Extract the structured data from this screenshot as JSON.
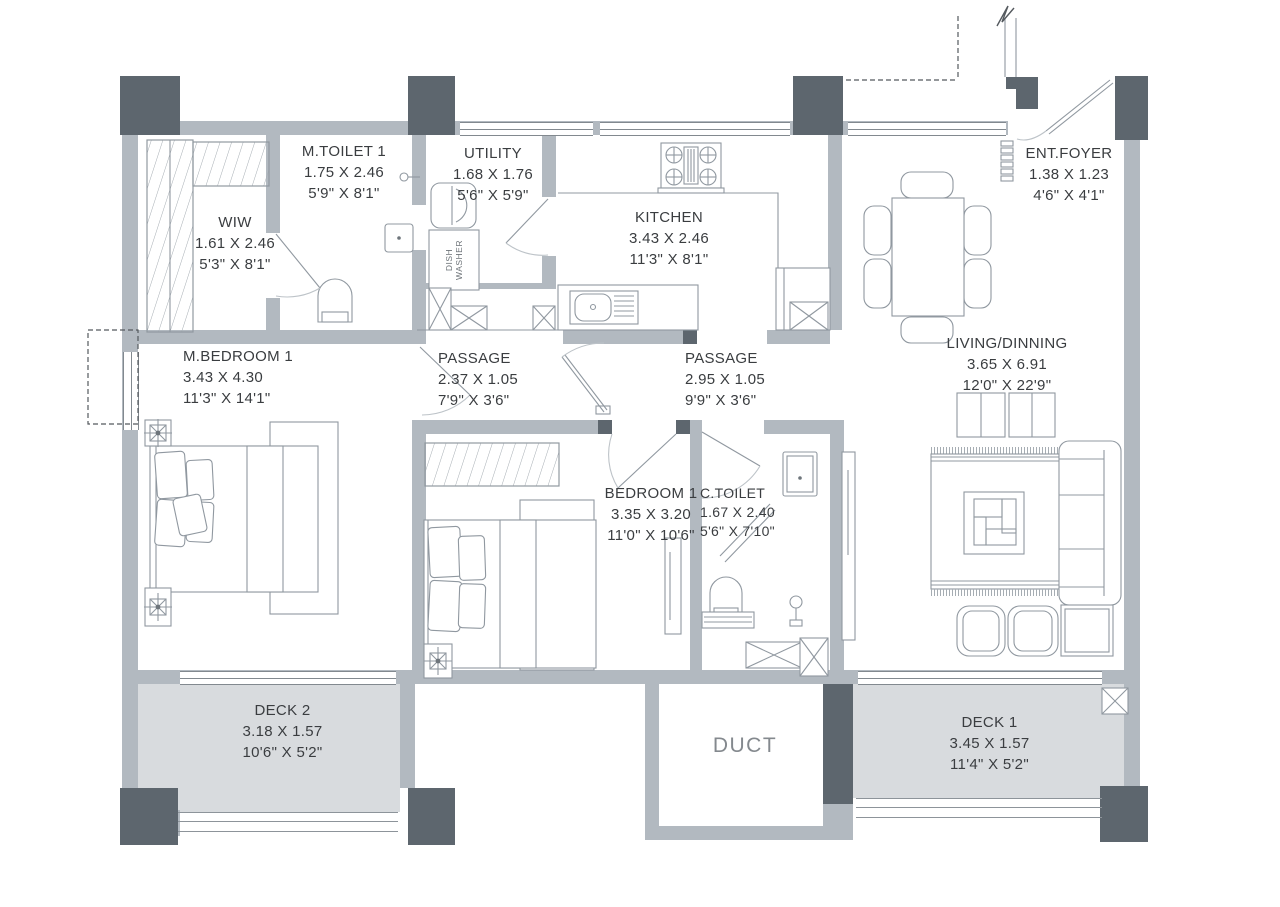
{
  "colors": {
    "wall_light": "#b2b9c0",
    "wall_dark": "#5d666e",
    "deck_fill": "#d8dbde",
    "furniture_line": "#9098a0",
    "text": "#3a3d40",
    "duct_text": "#84898e",
    "background": "#ffffff"
  },
  "rooms": {
    "m_toilet_1": {
      "name": "M.TOILET 1",
      "metric": "1.75 X 2.46",
      "imperial": "5'9\" X 8'1\""
    },
    "utility": {
      "name": "UTILITY",
      "metric": "1.68 X 1.76",
      "imperial": "5'6\" X 5'9\""
    },
    "kitchen": {
      "name": "KITCHEN",
      "metric": "3.43 X 2.46",
      "imperial": "11'3\" X 8'1\""
    },
    "ent_foyer": {
      "name": "ENT.FOYER",
      "metric": "1.38 X 1.23",
      "imperial": "4'6\" X 4'1\""
    },
    "wiw": {
      "name": "WIW",
      "metric": "1.61 X 2.46",
      "imperial": "5'3\" X 8'1\""
    },
    "m_bedroom_1": {
      "name": "M.BEDROOM 1",
      "metric": "3.43 X 4.30",
      "imperial": "11'3\" X 14'1\""
    },
    "passage_1": {
      "name": "PASSAGE",
      "metric": "2.37 X 1.05",
      "imperial": "7'9\" X 3'6\""
    },
    "passage_2": {
      "name": "PASSAGE",
      "metric": "2.95 X 1.05",
      "imperial": "9'9\" X 3'6\""
    },
    "living_dining": {
      "name": "LIVING/DINNING",
      "metric": "3.65 X 6.91",
      "imperial": "12'0\" X 22'9\""
    },
    "bedroom_1": {
      "name": "BEDROOM 1",
      "metric": "3.35 X 3.20",
      "imperial": "11'0\" X 10'6\""
    },
    "c_toilet": {
      "name": "C.TOILET",
      "metric": "1.67 X 2.40",
      "imperial": "5'6\" X 7'10\""
    },
    "deck_2": {
      "name": "DECK 2",
      "metric": "3.18 X 1.57",
      "imperial": "10'6\" X 5'2\""
    },
    "deck_1": {
      "name": "DECK 1",
      "metric": "3.45 X 1.57",
      "imperial": "11'4\" X 5'2\""
    },
    "duct": {
      "name": "DUCT"
    }
  },
  "appliances": {
    "dish_washer_line1": "DISH",
    "dish_washer_line2": "WASHER"
  }
}
